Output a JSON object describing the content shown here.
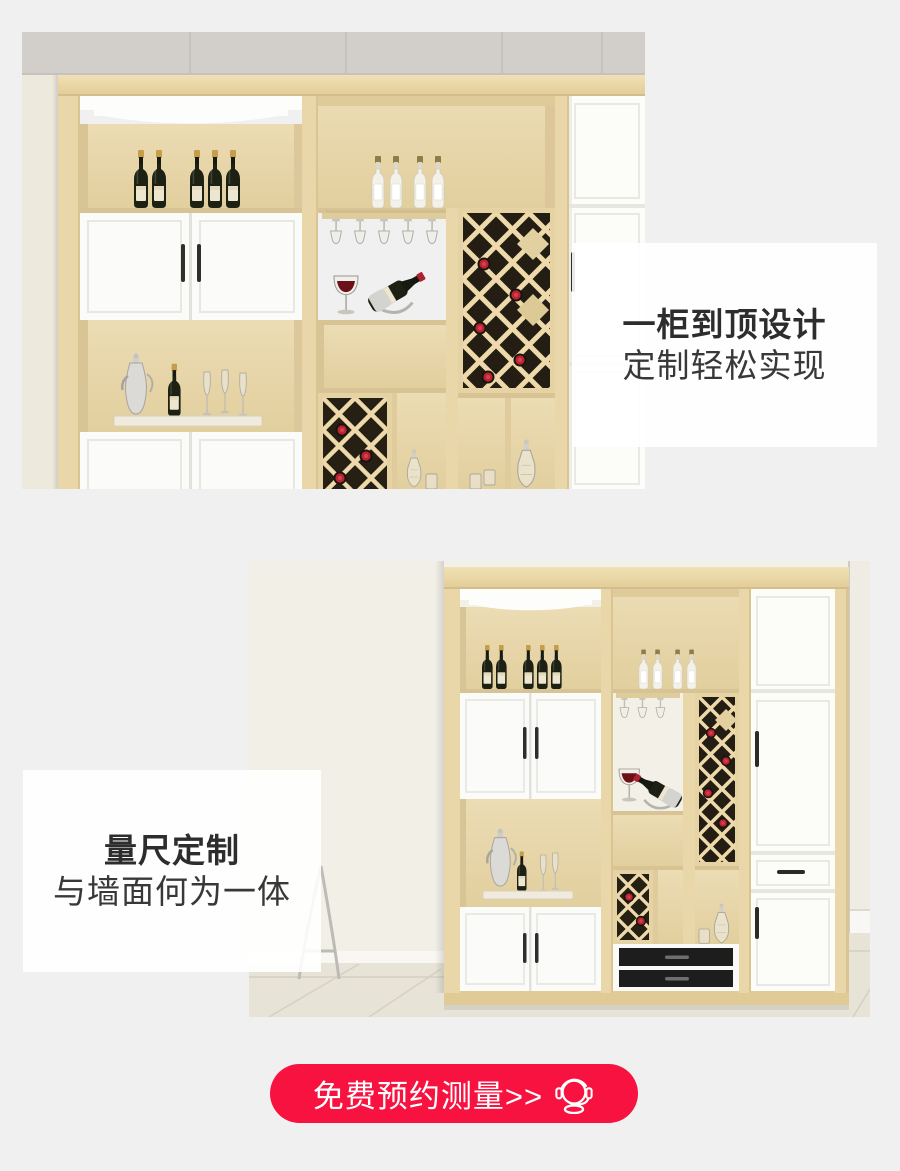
{
  "page": {
    "background": "#f0f0f0"
  },
  "section1": {
    "title": "一柜到顶设计",
    "subtitle": "定制轻松实现"
  },
  "section2": {
    "title": "量尺定制",
    "subtitle": "与墙面何为一体"
  },
  "cta": {
    "label": "免费预约测量>>",
    "icon": "headset-icon",
    "background": "#f71240",
    "text_color": "#ffffff"
  }
}
